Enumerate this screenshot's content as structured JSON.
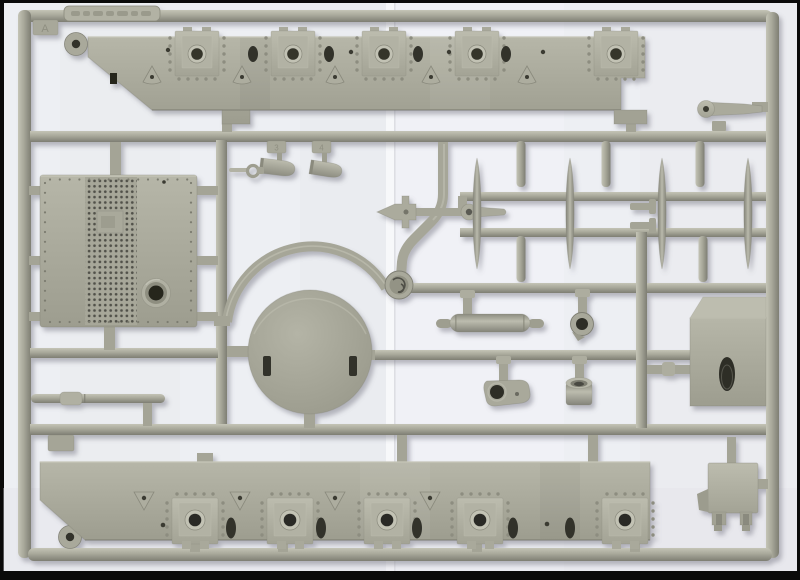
{
  "photo": {
    "subject": "Injection-molded plastic model kit sprue photographed on white paper",
    "material": "grey-green styrene plastic",
    "colors": {
      "plastic_base": "#a6a698",
      "plastic_highlight": "#c4c4b6",
      "plastic_shadow": "#7d7d72",
      "hole_dark": "#2e2e28",
      "paper": "#edeff3",
      "photo_border": "#0a0a0a"
    }
  },
  "sprue": {
    "gate_letter": "A",
    "part_number_tags": {
      "tag_3": "3",
      "tag_4": "4"
    },
    "label_plate": {
      "legible": false
    },
    "parts": [
      {
        "name": "hull-side-panel-top",
        "description": "long riveted panel with five hatch plates, oval slots and triangular brackets"
      },
      {
        "name": "hull-side-panel-bottom",
        "description": "mirrored long riveted panel with five hatch plates and V-brackets"
      },
      {
        "name": "perforated-grille-panel",
        "description": "square panel with perforated mesh band and round port"
      },
      {
        "name": "turret-ring-disc",
        "description": "large circular disc with two slots"
      },
      {
        "name": "torpedo-shaped-struts",
        "count": 4
      },
      {
        "name": "gun-barrel-cylinder"
      },
      {
        "name": "towing-shackle-ring"
      },
      {
        "name": "bracket-plate-with-hole"
      },
      {
        "name": "drum-cup"
      },
      {
        "name": "stowage-box-panel",
        "description": "box face with oval slot, drawn in slight perspective"
      },
      {
        "name": "mount-base-with-legs"
      },
      {
        "name": "crank-lever"
      },
      {
        "name": "bomb-shaped-parts",
        "count": 2
      },
      {
        "name": "hook-eyelet"
      },
      {
        "name": "anchor-shaped-fitting"
      },
      {
        "name": "paddle-lever"
      },
      {
        "name": "axle-rod"
      },
      {
        "name": "cable-reel-junction"
      }
    ]
  }
}
